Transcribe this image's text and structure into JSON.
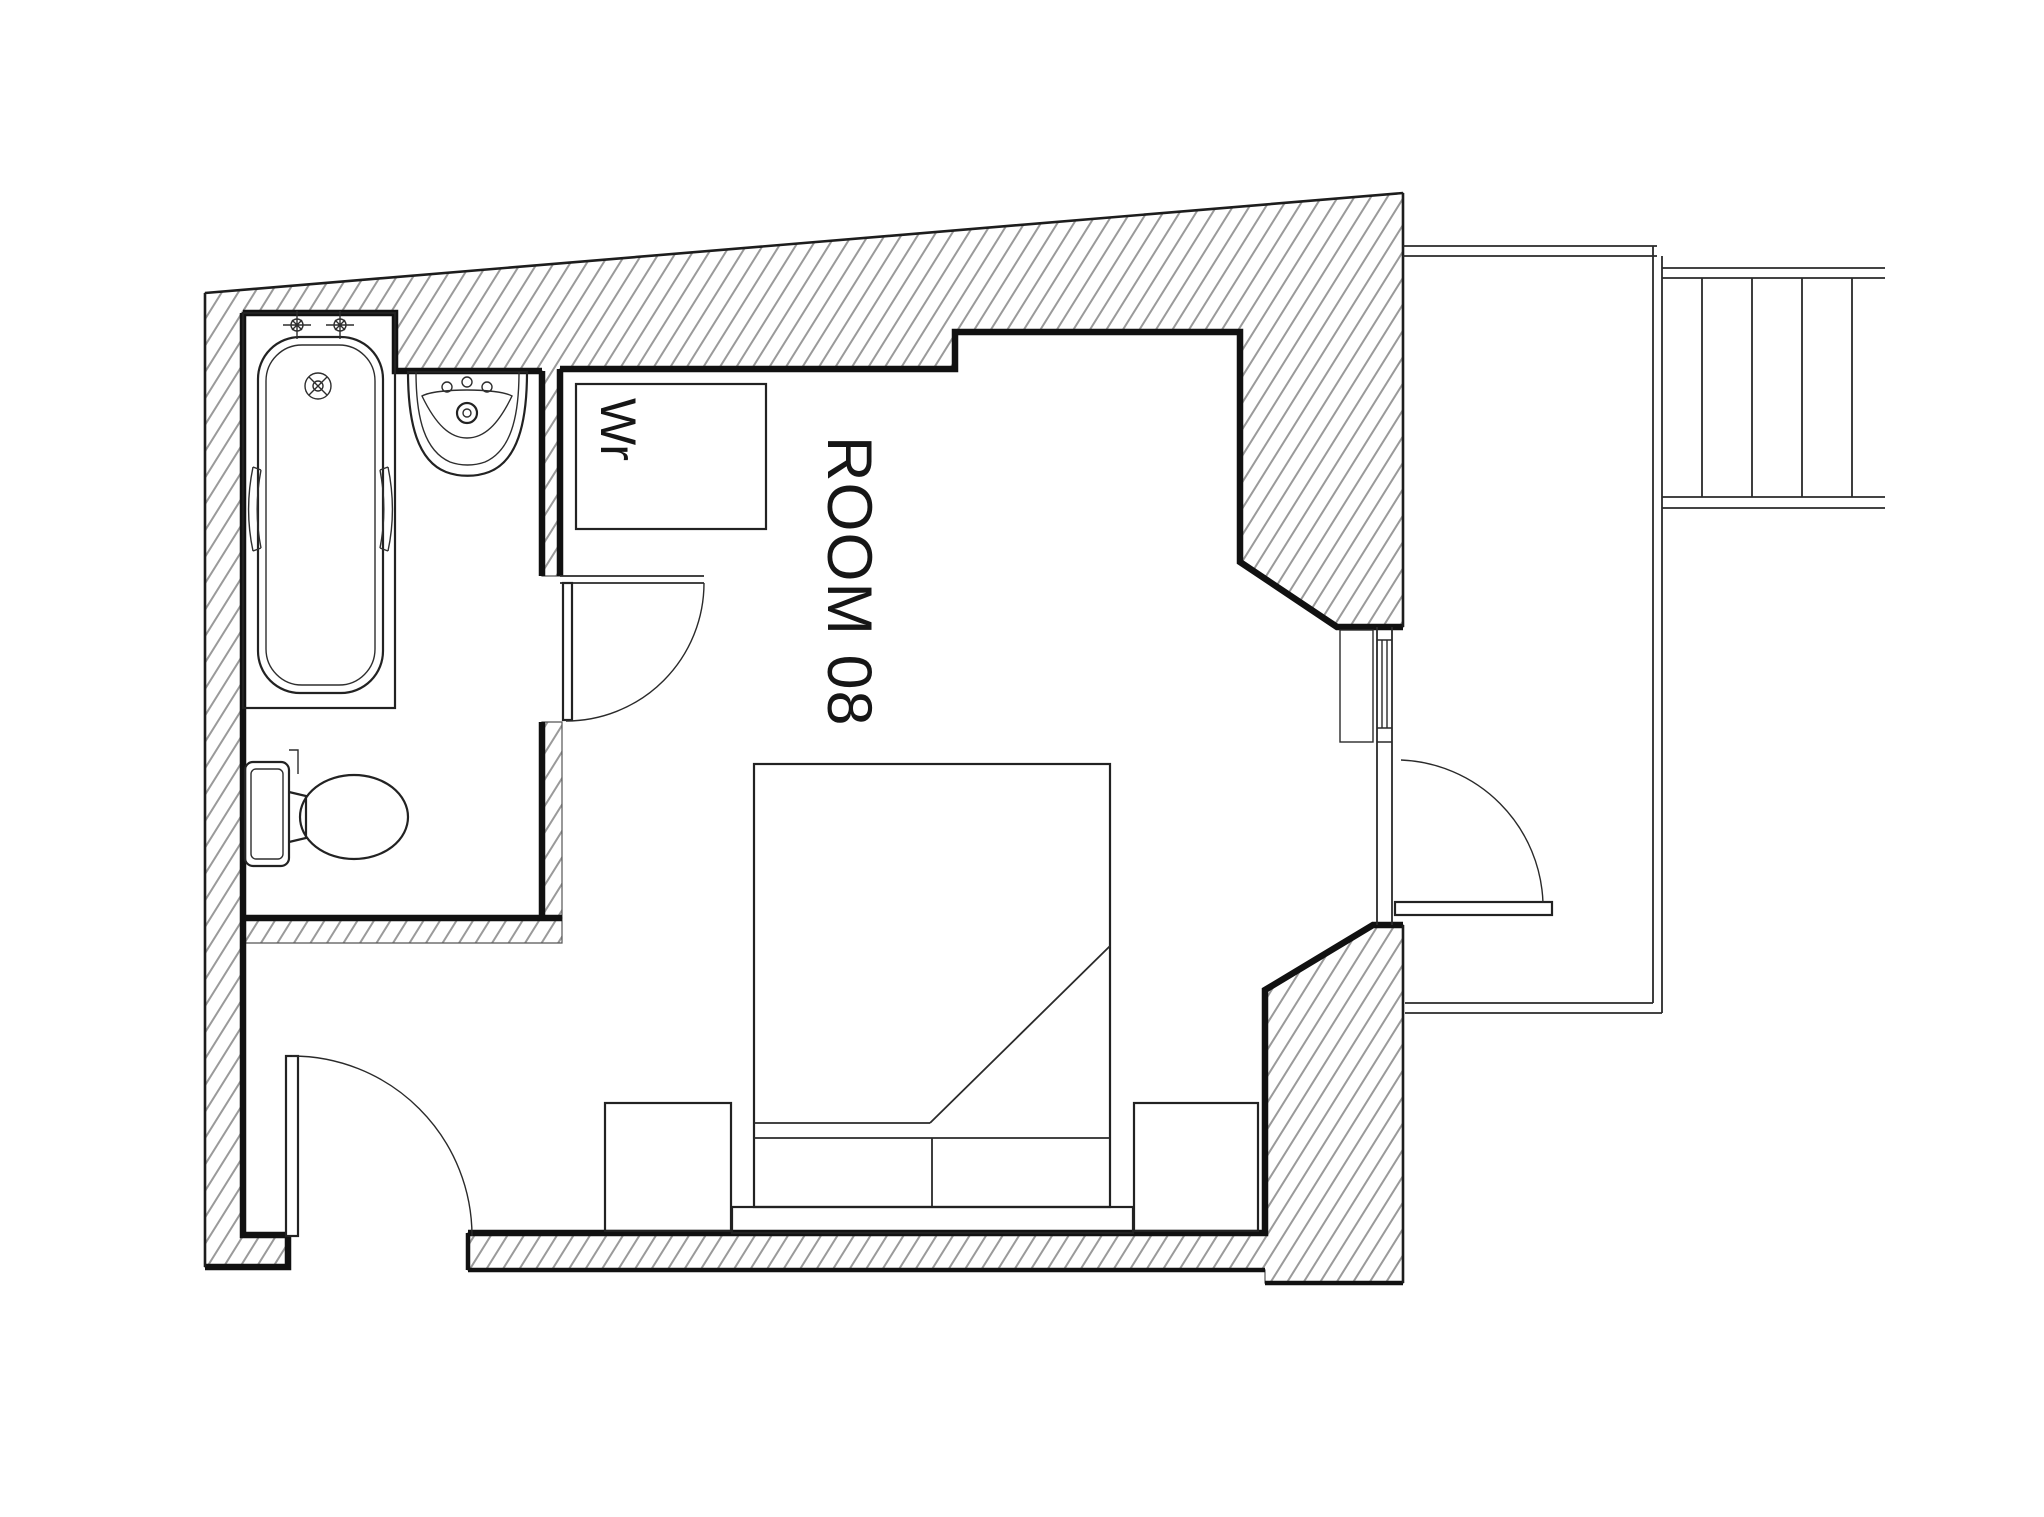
{
  "plan": {
    "room_label": "ROOM 08",
    "wardrobe_label": "Wr",
    "colors": {
      "background": "#ffffff",
      "wall_face_line": "#111111",
      "fixture_line": "#222222",
      "hatch_line": "#9a9a9a"
    }
  }
}
